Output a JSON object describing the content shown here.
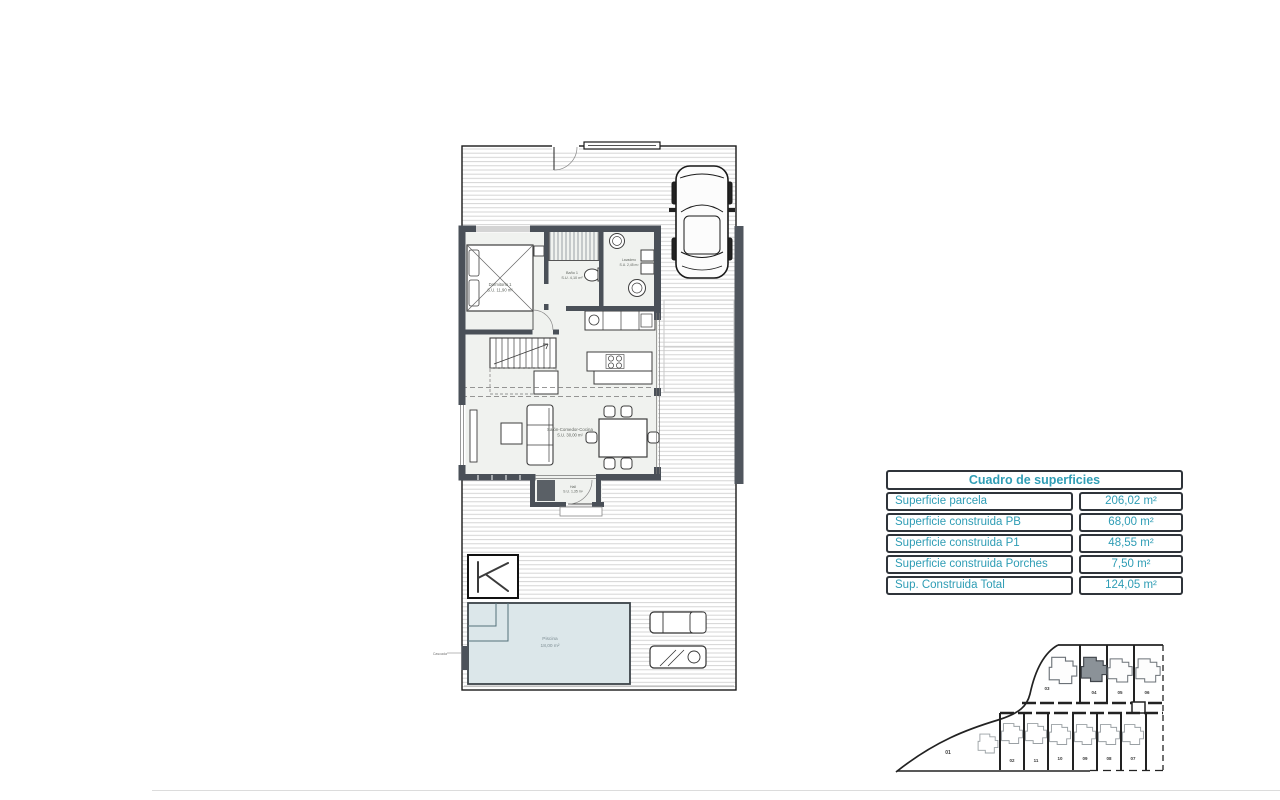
{
  "table": {
    "title": "Cuadro de superficies",
    "rows": [
      {
        "label": "Superficie parcela",
        "value": "206,02 m²"
      },
      {
        "label": "Superficie construida PB",
        "value": "68,00 m²"
      },
      {
        "label": "Superficie construida P1",
        "value": "48,55 m²"
      },
      {
        "label": "Superficie construida Porches",
        "value": "7,50 m²"
      },
      {
        "label": "Sup. Construida Total",
        "value": "124,05 m²"
      }
    ],
    "text_color": "#2f9db5",
    "border_color": "#2f343a"
  },
  "floorplan": {
    "labels": {
      "bedroom_line1": "Dormitorio 1",
      "bedroom_line2": "S.U. 11,90 m²",
      "bath_line1": "Baño 1",
      "bath_line2": "S.U. 4,10 m²",
      "laundry_line1": "Lavadero",
      "laundry_line2": "S.U. 2,45 m²",
      "living_line1": "Salón-Comedor-Cocina",
      "living_line2": "S.U. 30,00 m²",
      "hall_line1": "Hall",
      "hall_line2": "S.U. 1,35 m²",
      "pool_line1": "Piscina",
      "pool_line2": "18,00 m²",
      "cascada": "Cascada",
      "logo": "K"
    },
    "colors": {
      "wall": "#4a5058",
      "pool_fill": "#dce7ea",
      "hatch": "#d0d0d0"
    }
  },
  "siteplan": {
    "highlighted_lot": "04",
    "highlight_color": "#8b9298",
    "lot_left": "01",
    "lots_top": [
      "03",
      "04",
      "05",
      "06"
    ],
    "lots_bottom": [
      "02",
      "11",
      "10",
      "09",
      "08",
      "07"
    ]
  }
}
